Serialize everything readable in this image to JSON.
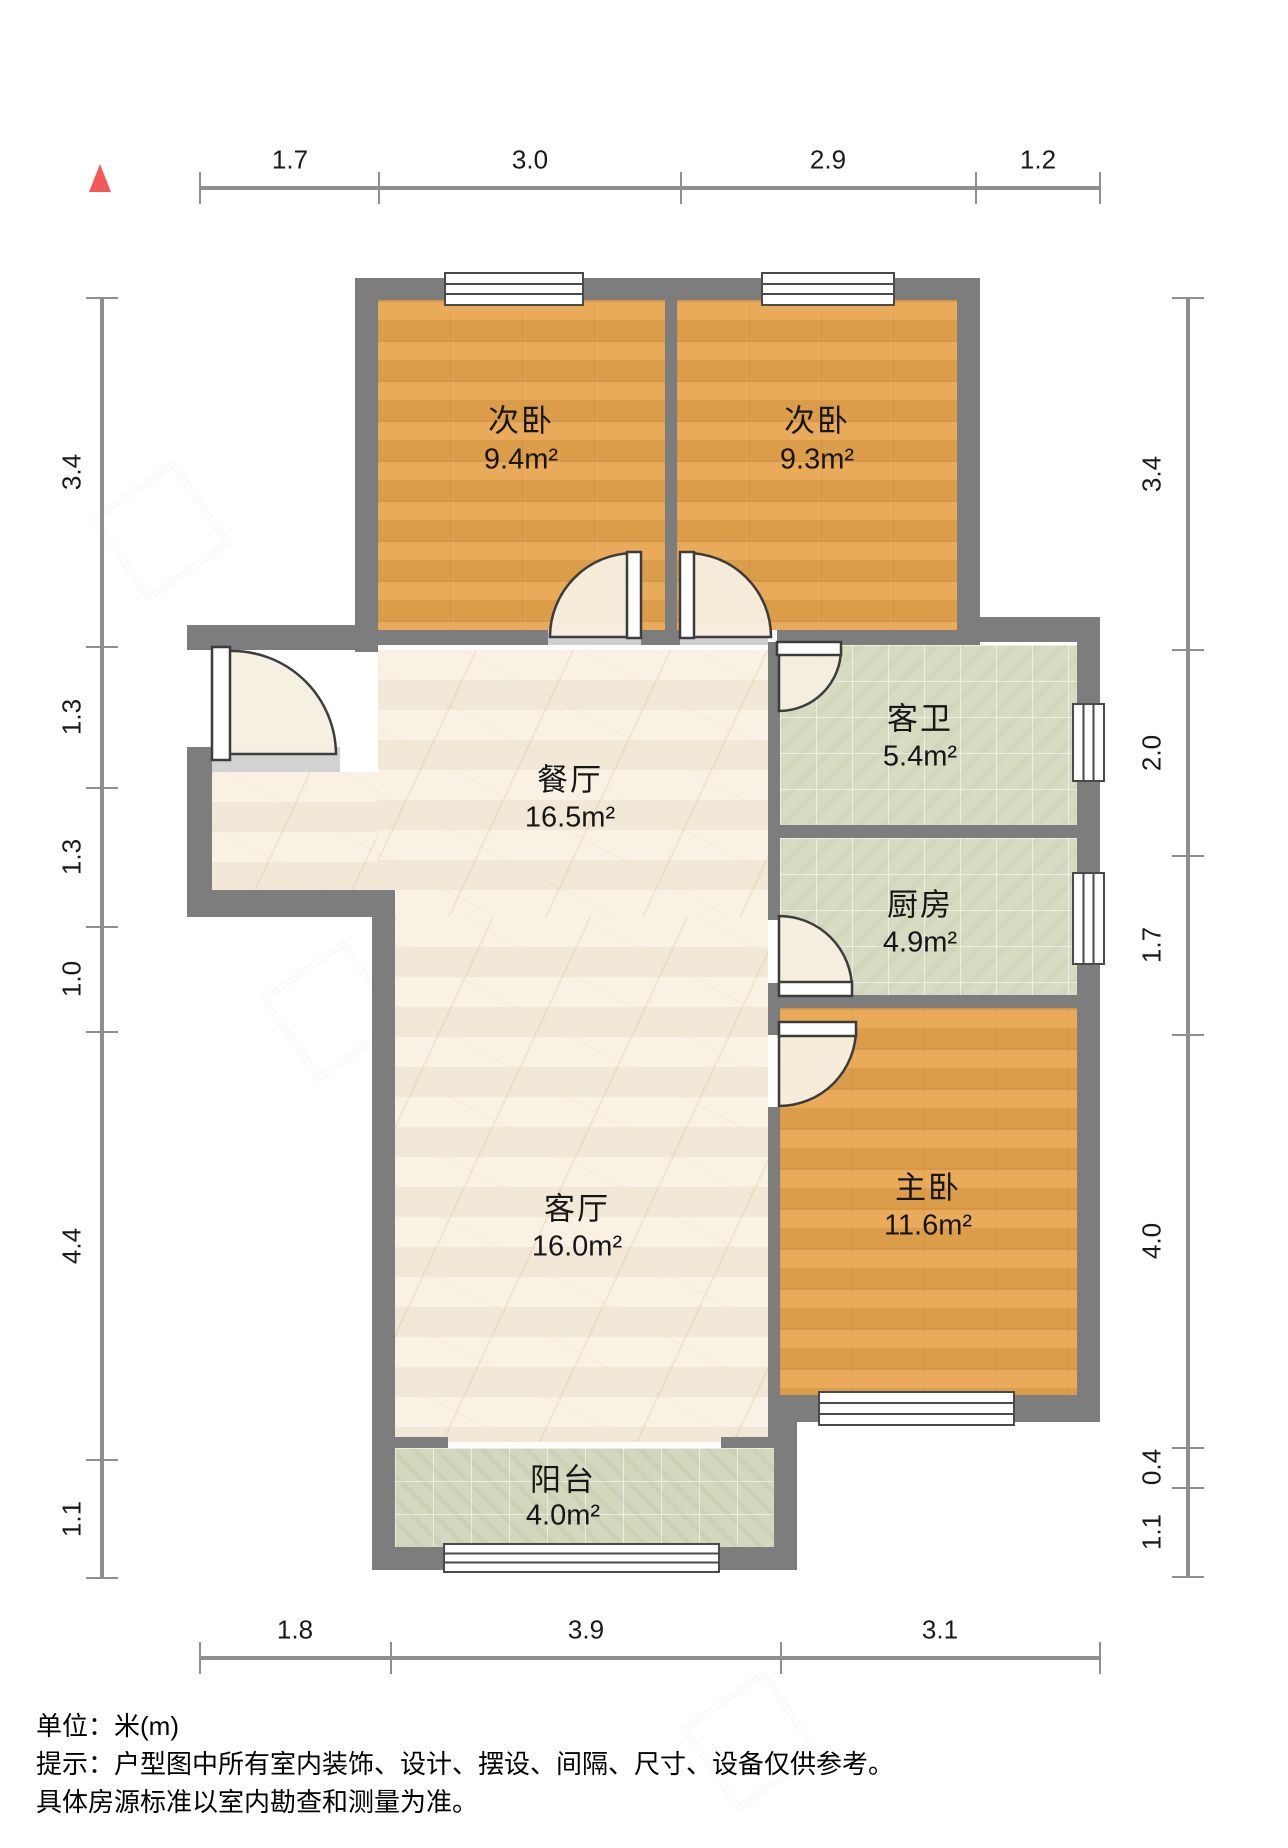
{
  "rooms": [
    {
      "name": "次卧",
      "area": "9.4m²"
    },
    {
      "name": "次卧",
      "area": "9.3m²"
    },
    {
      "name": "客卫",
      "area": "5.4m²"
    },
    {
      "name": "厨房",
      "area": "4.9m²"
    },
    {
      "name": "主卧",
      "area": "11.6m²"
    },
    {
      "name": "餐厅",
      "area": "16.5m²"
    },
    {
      "name": "客厅",
      "area": "16.0m²"
    },
    {
      "name": "阳台",
      "area": "4.0m²"
    }
  ],
  "dimensions": {
    "top": [
      "1.7",
      "3.0",
      "2.9",
      "1.2"
    ],
    "bottom": [
      "1.8",
      "3.9",
      "3.1"
    ],
    "left": [
      "3.4",
      "1.3",
      "1.3",
      "1.0",
      "4.4",
      "1.1"
    ],
    "right": [
      "3.4",
      "2.0",
      "1.7",
      "4.0",
      "0.4",
      "1.1"
    ]
  },
  "footer": {
    "unit": "单位：米(m)",
    "tip": "提示：户型图中所有室内装饰、设计、摆设、间隔、尺寸、设备仅供参考。",
    "tip2": "具体房源标准以室内勘查和测量为准。"
  },
  "colors": {
    "wall": "#7d7d7d",
    "wood": "#e7a54d",
    "tile": "#d8dbc2",
    "marble": "#f7eddb",
    "north_arrow": "#f4595a"
  }
}
